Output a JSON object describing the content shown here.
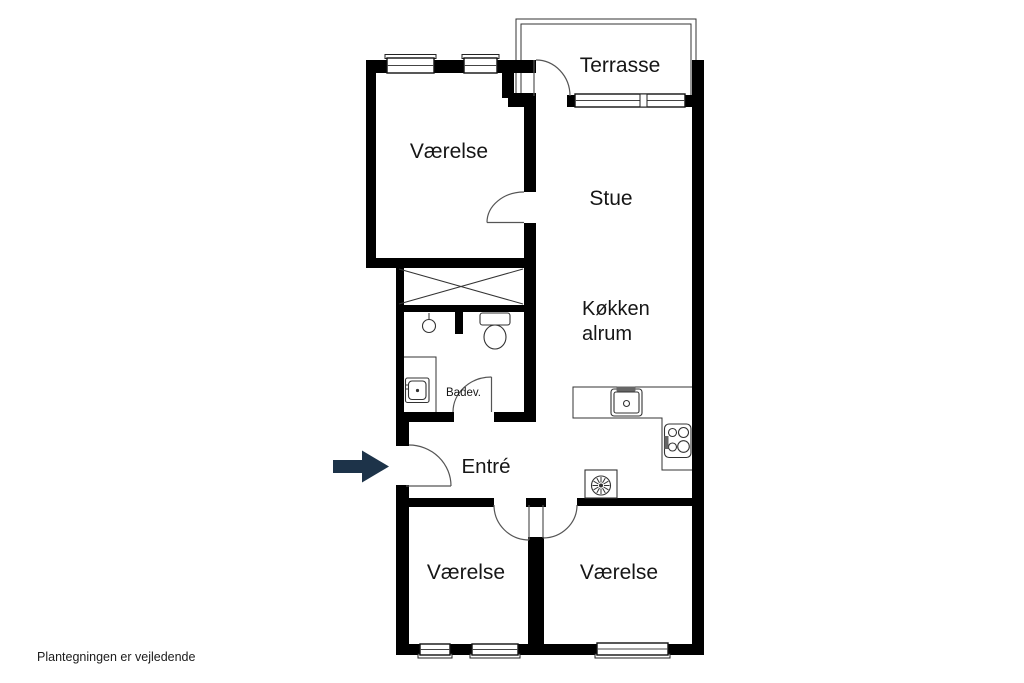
{
  "colors": {
    "background": "#ffffff",
    "wall": "#000000",
    "thin_line": "#333333",
    "arrow": "#1d3349",
    "text": "#161616"
  },
  "rooms": {
    "terrasse": {
      "label": "Terrasse"
    },
    "vaerelse_top": {
      "label": "Værelse"
    },
    "stue": {
      "label": "Stue"
    },
    "koekken": {
      "label_line1": "Køkken",
      "label_line2": "alrum"
    },
    "badevaerelse": {
      "label": "Badev."
    },
    "entre": {
      "label": "Entré"
    },
    "vaerelse_bottom_left": {
      "label": "Værelse"
    },
    "vaerelse_bottom_right": {
      "label": "Værelse"
    }
  },
  "icons": {
    "entrance_arrow": "right-arrow",
    "wardrobe": "crossed-box",
    "washbasin": "round-basin-with-stem",
    "toilet": "toilet-top-view",
    "washing_machine": "washing-machine-top-view",
    "kitchen_sink": "sink-top-view",
    "stove": "stove-four-burners",
    "extractor_fan": "fan-spiral"
  },
  "footer": {
    "disclaimer": "Plantegningen er vejledende"
  }
}
